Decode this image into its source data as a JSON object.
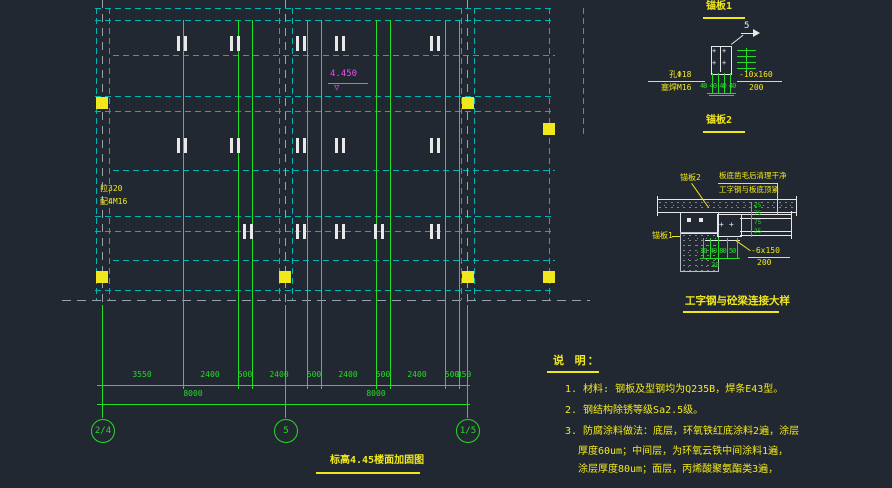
{
  "glyphs": {
    "bolt": "+",
    "tri_down": "▽"
  },
  "plan": {
    "title": "标高4.45楼面加固图",
    "elevation": "4.450",
    "label_line1": "拉320",
    "label_line2": "配4M16",
    "dims_row1": [
      "3550",
      "2400",
      "500",
      "2400",
      "500",
      "2400",
      "500",
      "2400",
      "500",
      "850"
    ],
    "dims_row2": [
      "8000",
      "8000"
    ],
    "bubbles": [
      "2/4",
      "5",
      "1/5"
    ]
  },
  "anchor1": {
    "title": "锚板1",
    "weld_size": "5",
    "hole_label": "孔Φ18",
    "plug_label": "塞焊M16",
    "plate_label": "-10x160",
    "plate_width": "200",
    "spacing": "40 40 40 40"
  },
  "anchor2": {
    "title": "锚板2"
  },
  "connection": {
    "title": "工字钢与砼梁连接大样",
    "anchor2_ref": "锚板2",
    "anchor1_ref": "锚板1",
    "note_line1": "板底凿毛后清理干净",
    "note_line2": "工字钢与板底顶紧",
    "plate_label": "-6x150",
    "plate_width": "200",
    "dims_vertical": [
      "25",
      "75",
      "75",
      "25"
    ],
    "dims_bottom": "10 40 80 50",
    "dim_20": "20"
  },
  "notes": {
    "heading": "说 明：",
    "line1": "1. 材料: 钢板及型钢均为Q235B，焊条E43型。",
    "line2": "2. 钢结构除锈等级Sa2.5级。",
    "line3a": "3. 防腐涂料做法：底层，环氧铁红底涂料2遍，涂层",
    "line3b": "厚度60um；中间层，为环氧云铁中间涂料1遍，",
    "line3c": "涂层厚度80um；面层，丙烯酸聚氨酯类3遍，"
  },
  "colors": {
    "background": "#222831",
    "cyan": "#00b5b5",
    "green": "#22dd22",
    "yellow": "#f0e81c",
    "white": "#e8e8e8",
    "magenta": "#e84fe8"
  }
}
